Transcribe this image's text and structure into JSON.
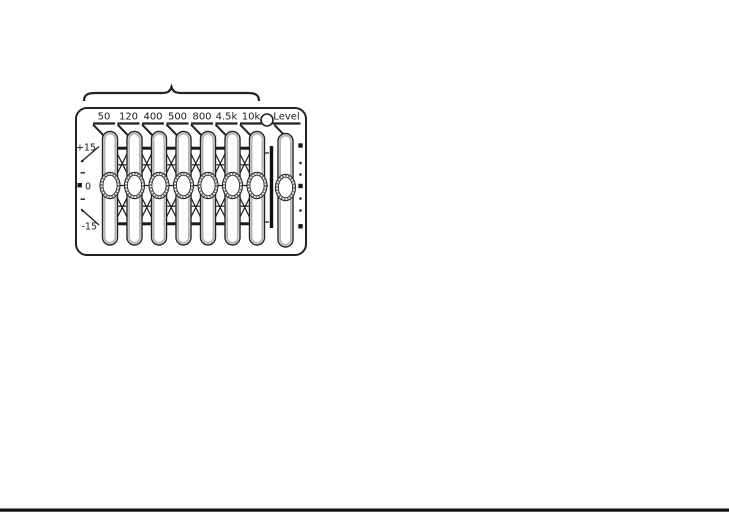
{
  "eq_panel": {
    "band_labels": [
      "50",
      "120",
      "400",
      "500",
      "800",
      "4.5k",
      "10k"
    ],
    "level_label": "Level",
    "scale": {
      "plus": "+15",
      "zero": "0",
      "minus": "-15"
    },
    "ink_color": "#1a1a1a",
    "shade_color": "#b5b5b5"
  }
}
